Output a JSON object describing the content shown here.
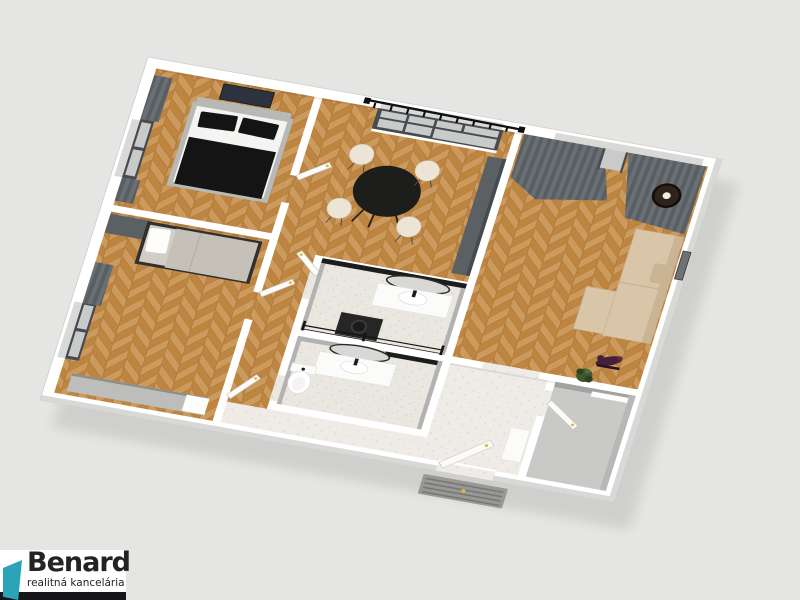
{
  "logo": {
    "name": "Benard",
    "tagline": "realitná kancelária"
  },
  "colors": {
    "bg": "#e5e5e3",
    "wall": "#ffffff",
    "wall_line": "#c8c8c6",
    "wood_a": "#cd9a5e",
    "wood_b": "#bd853f",
    "wood_line": "#9c6a2e",
    "tile": "#eae7e1",
    "tile_entry": "#efece7",
    "tile_dot": "#d6d2ca",
    "bath_wall": "#b2b2b0",
    "dark_band": "#1c1c1c",
    "curtain_a": "#6a6f73",
    "curtain_b": "#585f64",
    "window_frame": "#454b50",
    "glass": "#c9cbcb",
    "bed_black": "#141414",
    "bed_white": "#f4f4f2",
    "bed_gray": "#b8b8b6",
    "sofa": "#d9c6a8",
    "sofa_dark": "#c9b493",
    "table": "#1d1d1b",
    "chair": "#ece5d6",
    "cabinet_dark": "#5b6064",
    "sideboard": "#bdbdbb",
    "door": "#fbfbf9",
    "handle": "#e4b83e",
    "lamp": "#30231b",
    "plant": "#41582f",
    "bike": "#45203a",
    "mat": "#989896",
    "mat_line": "#767674",
    "mirror_rim": "#2a2a28",
    "mirror_glass": "#d8d8d6",
    "closet_floor": "#c9c9c7",
    "logo_accent": "#2ba4ba",
    "logo_bar": "#17161b",
    "logo_text": "#232326"
  },
  "scene": {
    "type": "3d-floorplan-render",
    "view": "axonometric top-down, rotated",
    "rooms": [
      {
        "name": "bedroom-1",
        "floor": "herringbone-wood",
        "items": [
          "double-bed",
          "black-pillows",
          "black-blanket",
          "wall-picture",
          "window",
          "dark-curtains"
        ]
      },
      {
        "name": "bedroom-2",
        "floor": "herringbone-wood",
        "items": [
          "single-bed",
          "dark-wardrobe",
          "gray-sideboard",
          "window",
          "dark-curtains"
        ]
      },
      {
        "name": "corridor",
        "floor": "herringbone-wood",
        "items": [
          "white-doors-with-yellow-handles"
        ]
      },
      {
        "name": "dining-room",
        "floor": "herringbone-wood",
        "items": [
          "round-black-table",
          "four-cream-chairs",
          "large-window",
          "black-curtain-rail",
          "tall-dark-cabinet"
        ]
      },
      {
        "name": "bathroom",
        "floor": "speckled-tile",
        "items": [
          "oval-mirror",
          "vanity-sink",
          "washing-machine",
          "glass-shower-screen",
          "black-tile-band"
        ]
      },
      {
        "name": "wc-bathroom",
        "floor": "speckled-tile",
        "items": [
          "oval-mirror",
          "vanity-sink",
          "toilet"
        ]
      },
      {
        "name": "living-room",
        "floor": "herringbone-wood",
        "items": [
          "beige-sofa",
          "gray-curtains",
          "pendant-lamp",
          "wall-art",
          "exercise-bike",
          "plant"
        ]
      },
      {
        "name": "entry-hall",
        "floor": "light-tile",
        "items": [
          "entrance-door",
          "doormat",
          "white-console"
        ]
      },
      {
        "name": "closet",
        "floor": "gray",
        "items": [
          "closet-door",
          "shelf"
        ]
      }
    ]
  }
}
